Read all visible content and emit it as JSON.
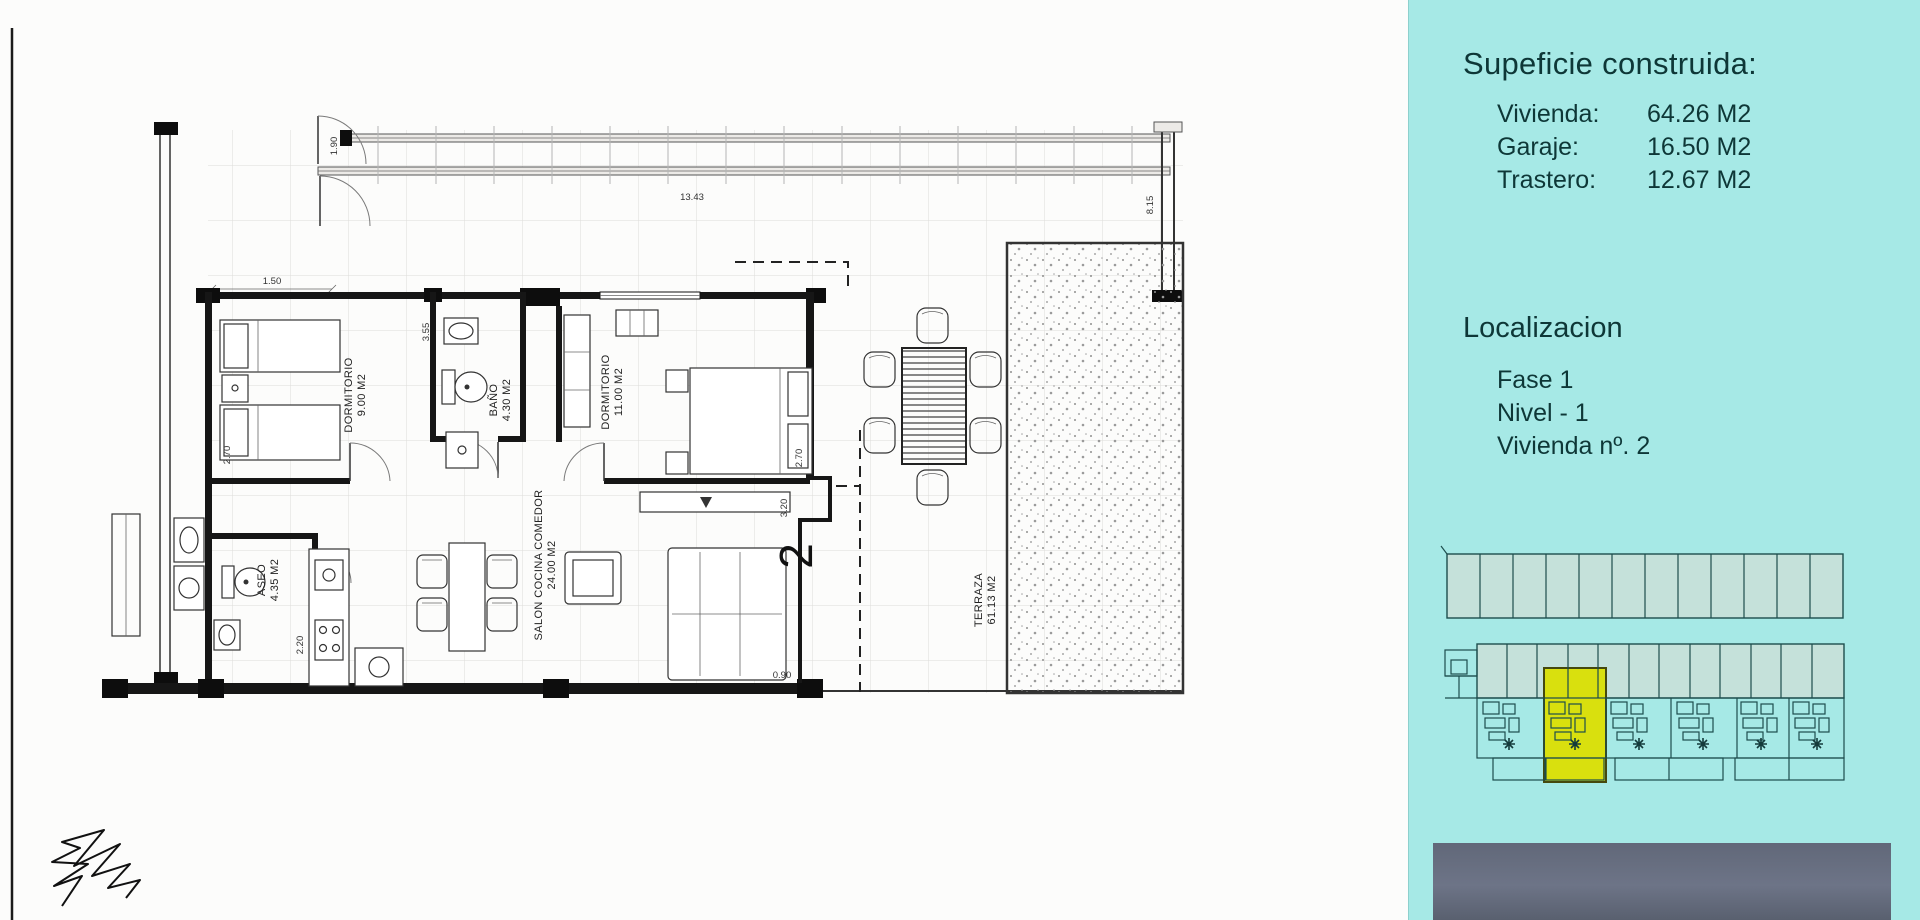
{
  "sidebar": {
    "surface": {
      "title": "Supeficie construida:",
      "rows": [
        {
          "label": "Vivienda:",
          "value": "64.26 M2"
        },
        {
          "label": "Garaje:",
          "value": "16.50 M2"
        },
        {
          "label": "Trastero:",
          "value": "12.67 M2"
        }
      ]
    },
    "location": {
      "title": "Localizacion",
      "rows": [
        "Fase 1",
        "Nivel - 1",
        "Vivienda nº. 2"
      ]
    }
  },
  "plan": {
    "unit_number": "2",
    "labels": [
      {
        "name": "DORMITORIO",
        "area": "9.00 M2"
      },
      {
        "name": "BAÑO",
        "area": "4.30 M2"
      },
      {
        "name": "DORMITORIO",
        "area": "11.00 M2"
      },
      {
        "name": "ASEO",
        "area": "4.35 M2"
      },
      {
        "name": "SALON COCINA COMEDOR",
        "area": "24.00 M2"
      },
      {
        "name": "TERRAZA",
        "area": "61.13 M2"
      }
    ],
    "dims": [
      "13.43",
      "8.15",
      "1.90",
      "1.50",
      "2.70",
      "3.55",
      "2.70",
      "3.20",
      "2.20",
      "0.90"
    ]
  },
  "colors": {
    "sidebar_bg": "#a6e9e6",
    "sidebar_text": "#0e3737",
    "highlight_yellow": "#d9e00e",
    "photo_slate": "#5c6373",
    "minimap_line": "#1d4d4d"
  }
}
